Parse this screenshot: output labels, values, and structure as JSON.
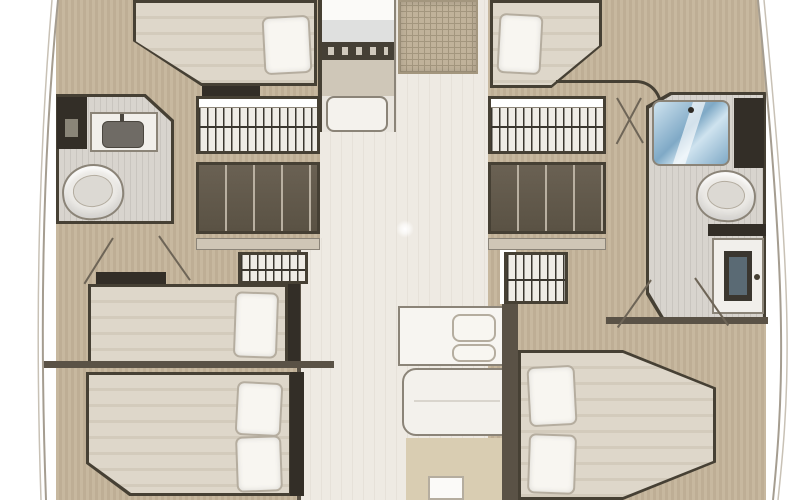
{
  "plan": {
    "kind": "catamaran-interior-floor-plan",
    "orientation": "bow-at-top",
    "rooms": {
      "port_hull": {
        "forward_cabin": {
          "items": [
            "double-berth",
            "pillow",
            "step-locker"
          ]
        },
        "bathroom": {
          "items": [
            "tall-cabinet",
            "mirror",
            "sink-vanity",
            "basin",
            "toilet"
          ]
        },
        "storage": {
          "items": [
            "hanging-wardrobe",
            "shelved-locker",
            "shelf",
            "small-hanging-wardrobe"
          ]
        },
        "mid_cabin": {
          "items": [
            "single-berth",
            "pillow",
            "headboard-shelf"
          ]
        },
        "aft_cabin": {
          "items": [
            "double-berth",
            "pillow",
            "pillow"
          ]
        }
      },
      "starboard_hull": {
        "forward_cabin": {
          "items": [
            "berth",
            "pillow"
          ]
        },
        "storage": {
          "items": [
            "hanging-wardrobe",
            "shelved-locker",
            "shelf",
            "small-hanging-wardrobe"
          ]
        },
        "bathroom": {
          "items": [
            "shower-stall",
            "tall-cabinet",
            "toilet",
            "counter",
            "vanity-cabinet"
          ]
        },
        "aft_cabin": {
          "items": [
            "double-berth",
            "pillow",
            "pillow"
          ]
        }
      },
      "center_bridgedeck": {
        "galley": {
          "items": [
            "counter",
            "stove-with-knobs",
            "sink-module"
          ]
        },
        "deck": {
          "items": [
            "hatch-mat",
            "ceiling-light"
          ]
        },
        "salon": {
          "items": [
            "settee-bench",
            "seat-cushion",
            "seat-cushion",
            "table",
            "rug",
            "companionway-step"
          ]
        }
      }
    }
  },
  "colors": {
    "deck": "#c4b49a",
    "salon_floor": "#eeeae3",
    "salon_stripe": "#e6e1d9",
    "outline": "#464034",
    "wall": "#5a5246",
    "bed": "#ded7ca",
    "bed_stripe": "#d3cbbc",
    "pillow": "#f8f6f1",
    "pillow_edge": "#b5ad9f",
    "bath_floor": "#d8d4ce",
    "bath_stripe": "#c9c5bf",
    "shower_light": "#cfe3ef",
    "shower_dark": "#7fa9c6",
    "dark_cabinet": "#332e27",
    "locker": "#5a5244",
    "locker_divider": "#b9b0a1",
    "hanger_bg": "#efece6",
    "hanger_line": "#3a362f",
    "shelf": "#cfc6b6",
    "rug": "#d9cdb2",
    "mat": "#c0b29a",
    "mat_line": "#a3967e",
    "galley_body": "#cfc7b8",
    "stove": "#454036",
    "white": "#fbfaf8",
    "fixture_edge": "#8b8478",
    "hull_line": "#a59d90",
    "door_line": "#6e6557"
  }
}
